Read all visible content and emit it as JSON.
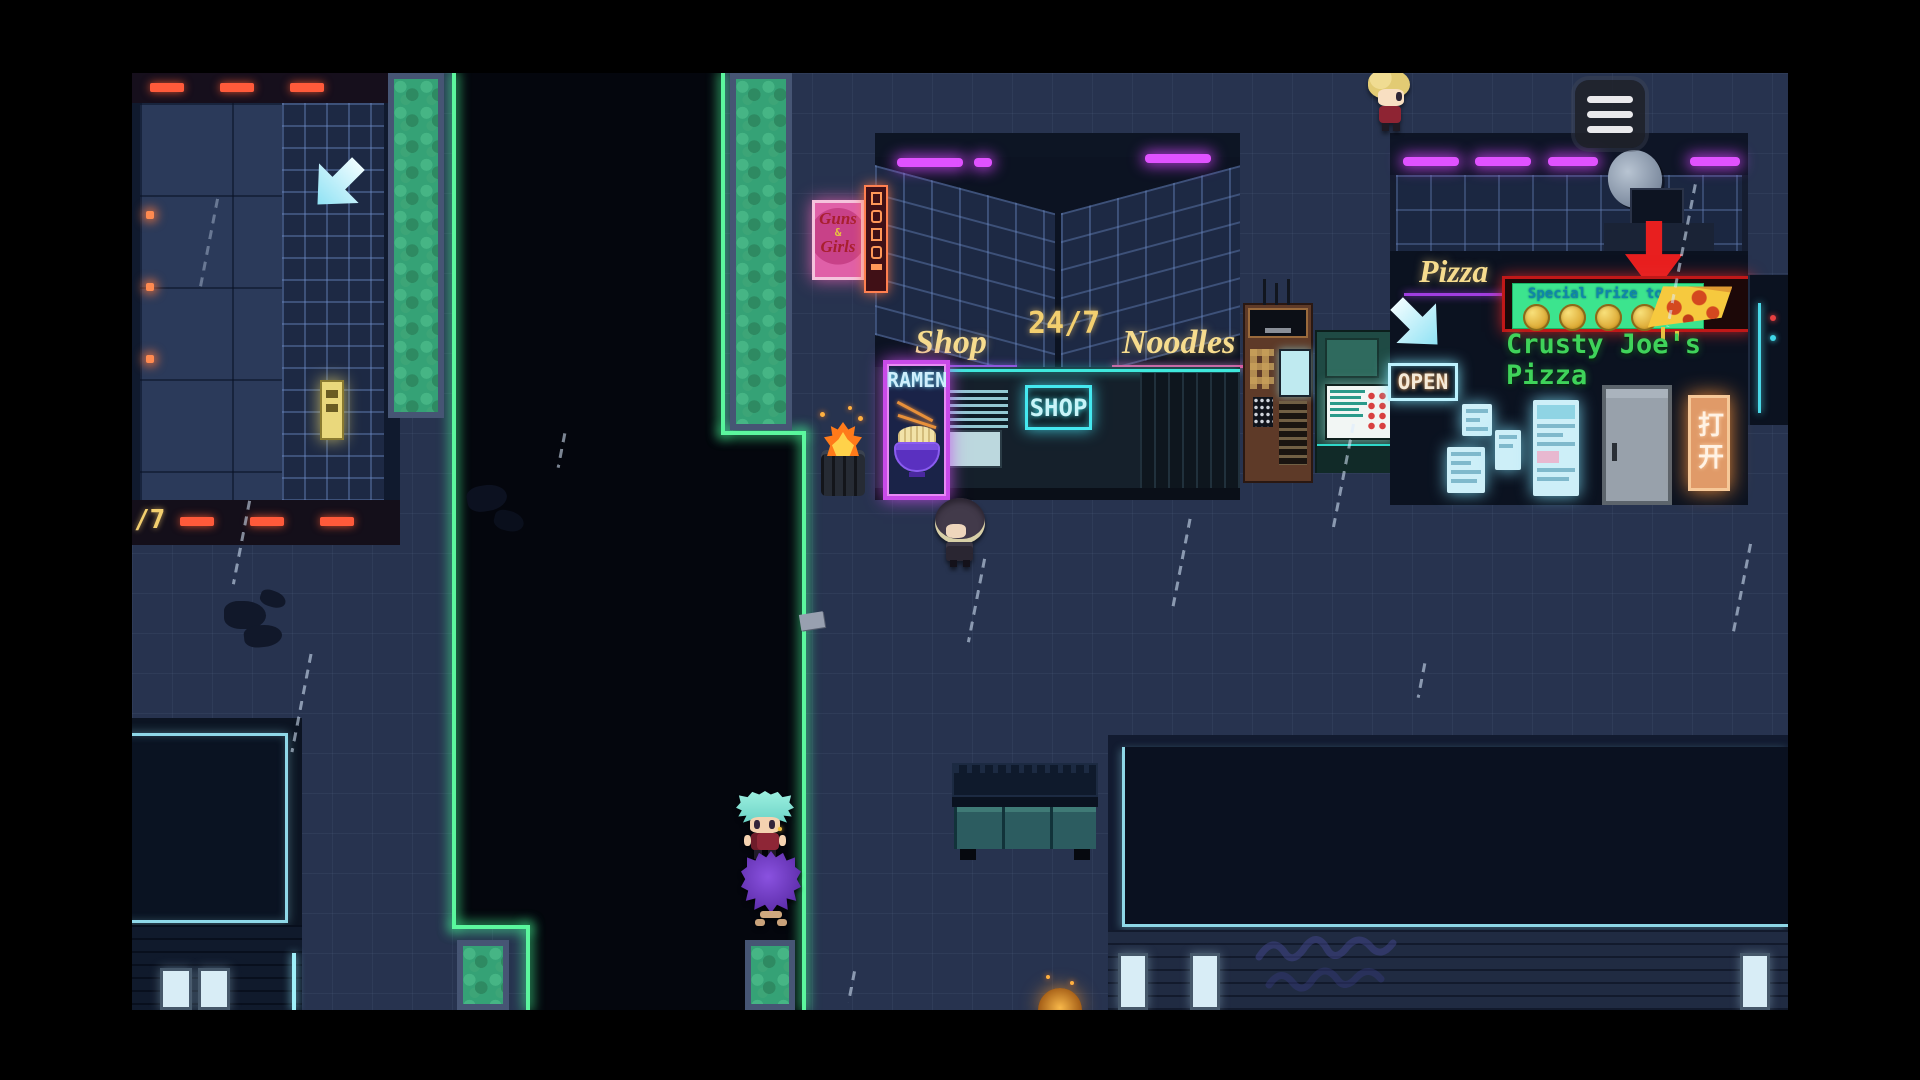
{
  "hud": {
    "menu_button": {
      "icon": "hamburger-menu-icon"
    }
  },
  "district": {
    "left_sign_fragment": "/7"
  },
  "noodle_shop": {
    "adult_sign_line1": "Guns",
    "adult_sign_amp": "&",
    "adult_sign_line2": "Girls",
    "awning_left": "Shop",
    "awning_hours": "24/7",
    "awning_right": "Noodles",
    "ramen_banner": "RAMEN",
    "window_neon": "SHOP"
  },
  "pizza_shop": {
    "awning_label": "Pizza",
    "special_sign_text": "Special Prize today",
    "name_sign": "Crusty Joe's Pizza",
    "open_sign": "OPEN",
    "door_side_sign": "打开"
  },
  "colors": {
    "neon_green": "#5cf79e",
    "neon_cyan": "#53e6f2",
    "neon_magenta": "#e052ff",
    "underline_purple": "#a03ee0",
    "underline_pink": "#e0559f",
    "sign_gold": "#f7dc8e",
    "pizza_name_green": "#3fd35a",
    "special_sign_green": "#3ce48e",
    "alert_arrow_red": "#e81f1f",
    "adult_sign_pink": "#e060a8",
    "open_sign_warm_white": "#f5ead8"
  },
  "entities": {
    "player": "teal-haired-girl",
    "companion": "purple-fluff-creature",
    "npc_hooded": "hooded-figure",
    "npc_blonde": "blonde-npc"
  }
}
